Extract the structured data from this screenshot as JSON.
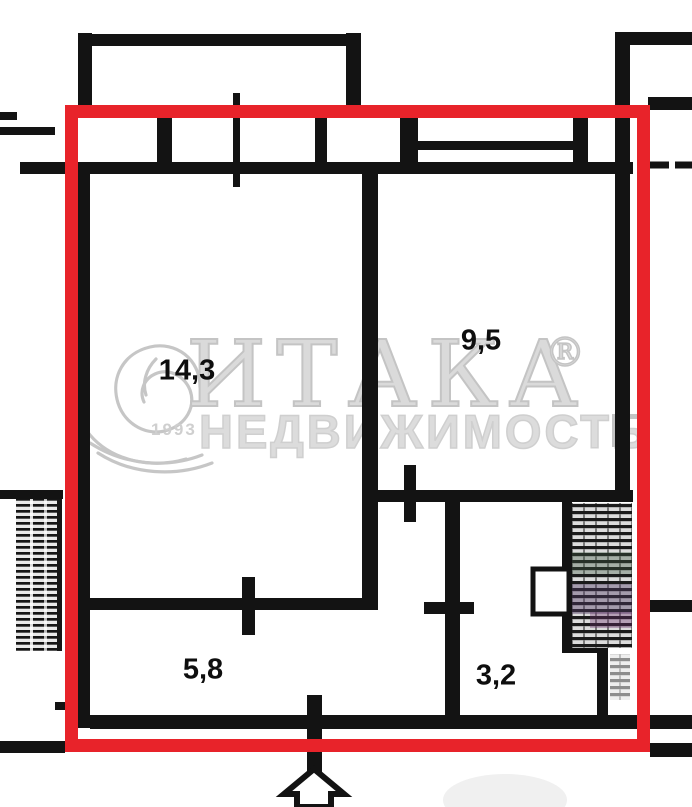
{
  "plan": {
    "rooms": [
      {
        "label": "14,3"
      },
      {
        "label": "9,5"
      },
      {
        "label": "5,8"
      },
      {
        "label": "3,2"
      }
    ]
  },
  "watermark": {
    "brand": "ИТАКА",
    "registered_mark": "®",
    "subtitle": "НЕДВИЖИМОСТЬ",
    "year": "1993"
  },
  "colors": {
    "boundary_red": "#e8232a",
    "wall_black": "#131313",
    "watermark_gray": "#c4c4c4",
    "watermark_faint": "#cfcfcf"
  }
}
